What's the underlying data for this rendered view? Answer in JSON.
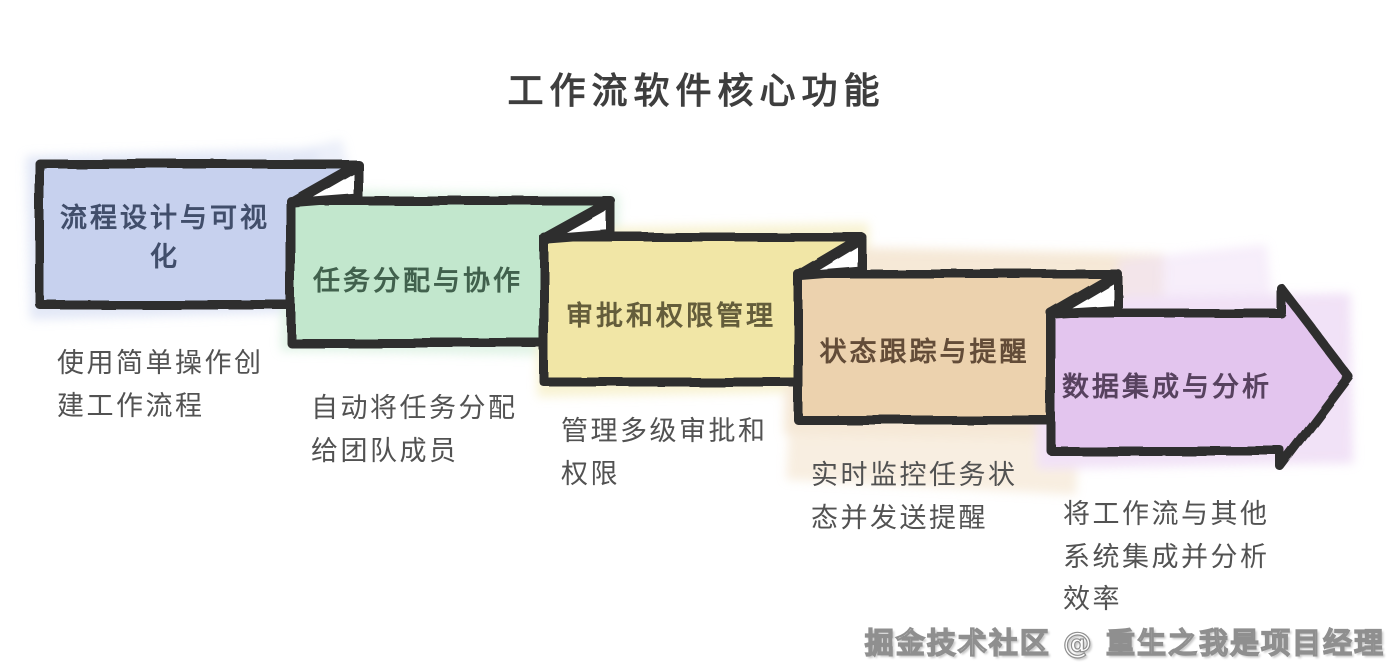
{
  "title": "工作流软件核心功能",
  "background": "#ffffff",
  "stroke_color": "#2e2e2e",
  "boxes": [
    {
      "label": "流程设计与可视化",
      "description": "使用简单操作创建工作流程",
      "fill": "#c7d1ee",
      "label_color": "#414e6b"
    },
    {
      "label": "任务分配与协作",
      "description": "自动将任务分配给团队成员",
      "fill": "#c2e7cd",
      "label_color": "#41614d"
    },
    {
      "label": "审批和权限管理",
      "description": "管理多级审批和权限",
      "fill": "#f1e6a6",
      "label_color": "#645d3b"
    },
    {
      "label": "状态跟踪与提醒",
      "description": "实时监控任务状态并发送提醒",
      "fill": "#ecd2ae",
      "label_color": "#634c38"
    },
    {
      "label": "数据集成与分析",
      "description": "将工作流与其他系统集成并分析效率",
      "fill": "#e3c5ee",
      "label_color": "#57425f"
    }
  ],
  "watermark": "掘金技术社区 @ 重生之我是项目经理"
}
